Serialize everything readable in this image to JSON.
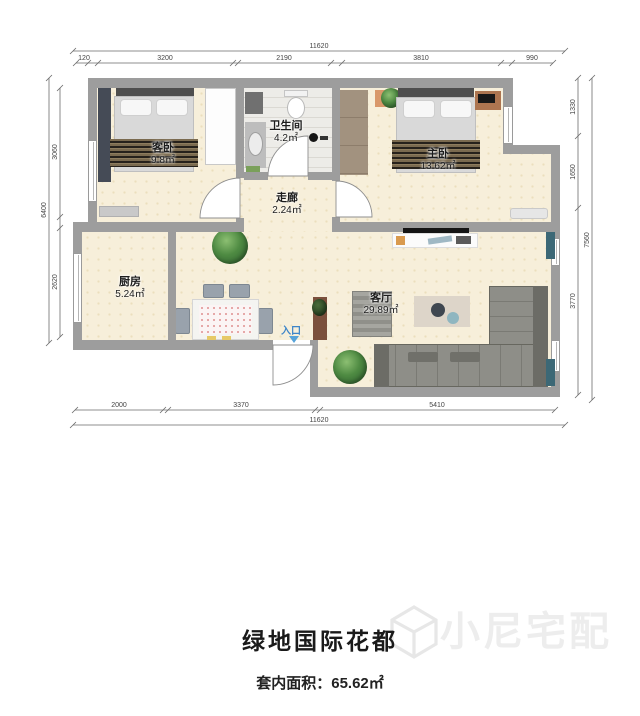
{
  "title": "绿地国际花都",
  "area_caption": {
    "label": "套内面积：",
    "value": "65.62㎡"
  },
  "watermark": "小尼宅配",
  "entry_label": "入口",
  "rooms": {
    "guest": {
      "name": "客卧",
      "area": "9.8㎡"
    },
    "bath": {
      "name": "卫生间",
      "area": "4.2㎡"
    },
    "corridor": {
      "name": "走廊",
      "area": "2.24㎡"
    },
    "master": {
      "name": "主卧",
      "area": "13.62㎡"
    },
    "kitchen": {
      "name": "厨房",
      "area": "5.24㎡"
    },
    "living": {
      "name": "客厅",
      "area": "29.89㎡"
    }
  },
  "dimensions": {
    "top_total": "11620",
    "top_segments": [
      "120",
      "3200",
      "2190",
      "3810",
      "990"
    ],
    "left_total": "6400",
    "left_segments": [
      "3060",
      "2620"
    ],
    "right_total": "7560",
    "right_segments": [
      "1330",
      "1650",
      "3770"
    ],
    "bottom_total": "11620",
    "bottom_segments": [
      "2000",
      "3370",
      "5410"
    ]
  },
  "colors": {
    "wall": "#9d9d9d",
    "floor": "#f7efda",
    "entry_accent": "#3d85c8"
  }
}
